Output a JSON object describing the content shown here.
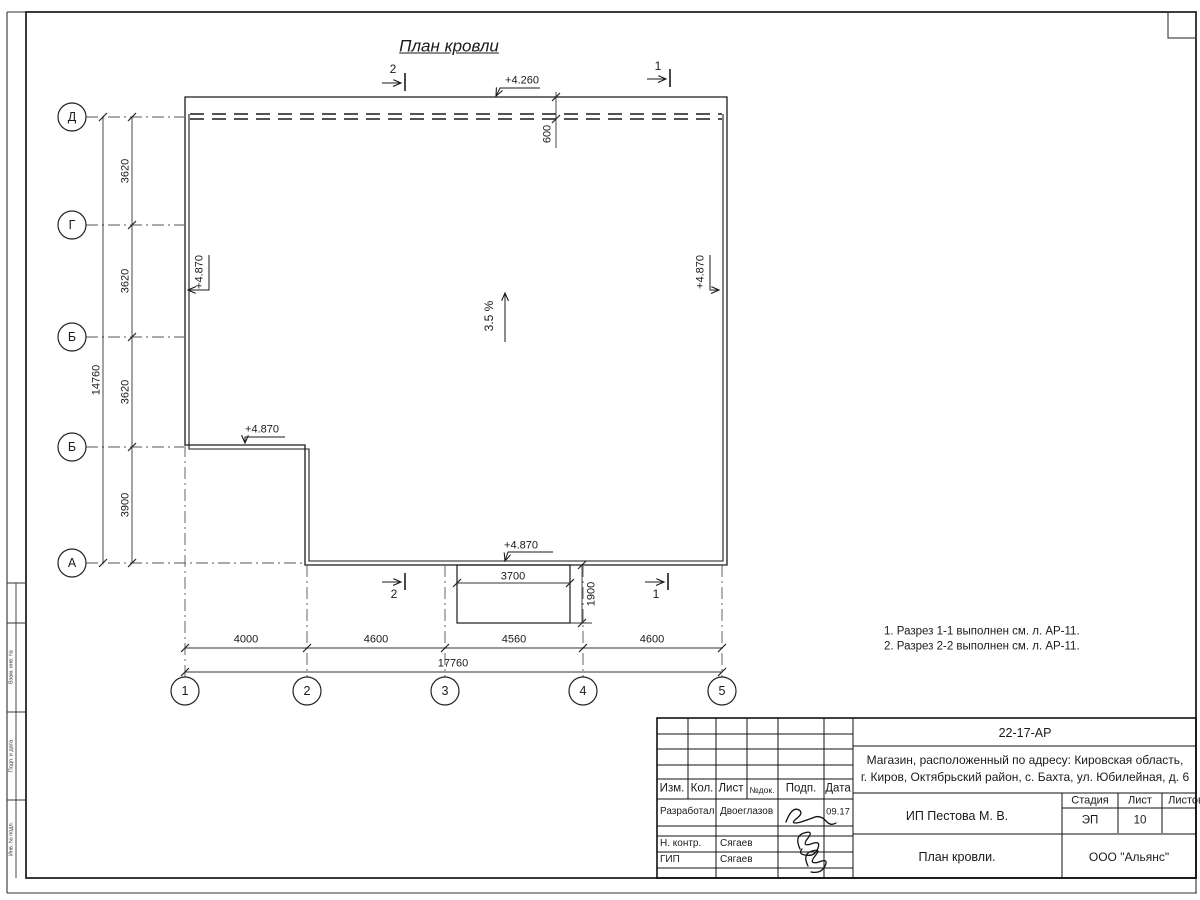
{
  "plan": {
    "title": "План кровли",
    "slope": "3.5 %",
    "elev_top": "+4.260",
    "elev_left": "+4.870",
    "elev_right": "+4.870",
    "elev_notch": "+4.870",
    "elev_bottom": "+4.870",
    "overhang_dim": "600",
    "porch_width": "3700",
    "porch_depth": "1900",
    "section1": "1",
    "section2": "2"
  },
  "grid": {
    "rows": [
      "Д",
      "Г",
      "Б",
      "Б",
      "А"
    ],
    "row_dims": [
      "3620",
      "3620",
      "3620",
      "3900"
    ],
    "row_total": "14760",
    "cols": [
      "1",
      "2",
      "3",
      "4",
      "5"
    ],
    "col_dims": [
      "4000",
      "4600",
      "4560",
      "4600"
    ],
    "col_total": "17760"
  },
  "notes": {
    "line1": "1. Разрез 1-1 выполнен см. л. АР-11.",
    "line2": "2. Разрез 2-2 выполнен см. л. АР-11."
  },
  "titleblock": {
    "code": "22-17-АР",
    "address_line1": "Магазин, расположенный по адресу: Кировская область,",
    "address_line2": "г. Киров, Октябрьский район, с. Бахта, ул. Юбилейная, д. 6",
    "header_cells": [
      "Изм.",
      "Кол.",
      "Лист",
      "№док.",
      "Подп.",
      "Дата"
    ],
    "rows": [
      {
        "role": "Разработал",
        "name": "Двоеглазов",
        "date": "09.17"
      },
      {
        "role": "Н. контр.",
        "name": "Сягаев",
        "date": ""
      },
      {
        "role": "ГИП",
        "name": "Сягаев",
        "date": ""
      }
    ],
    "stage_header": [
      "Стадия",
      "Лист",
      "Листов"
    ],
    "stage": "ЭП",
    "sheet": "10",
    "client": "ИП Пестова М. В.",
    "sheet_title": "План кровли.",
    "company": "ООО \"Альянс\""
  },
  "left_margin": {
    "labels": [
      "Взам. инв. №",
      "Подп. и дата",
      "Инв. № подл."
    ]
  },
  "colors": {
    "line": "#1a1a1a",
    "thin_line": "#555555",
    "background": "#ffffff"
  }
}
